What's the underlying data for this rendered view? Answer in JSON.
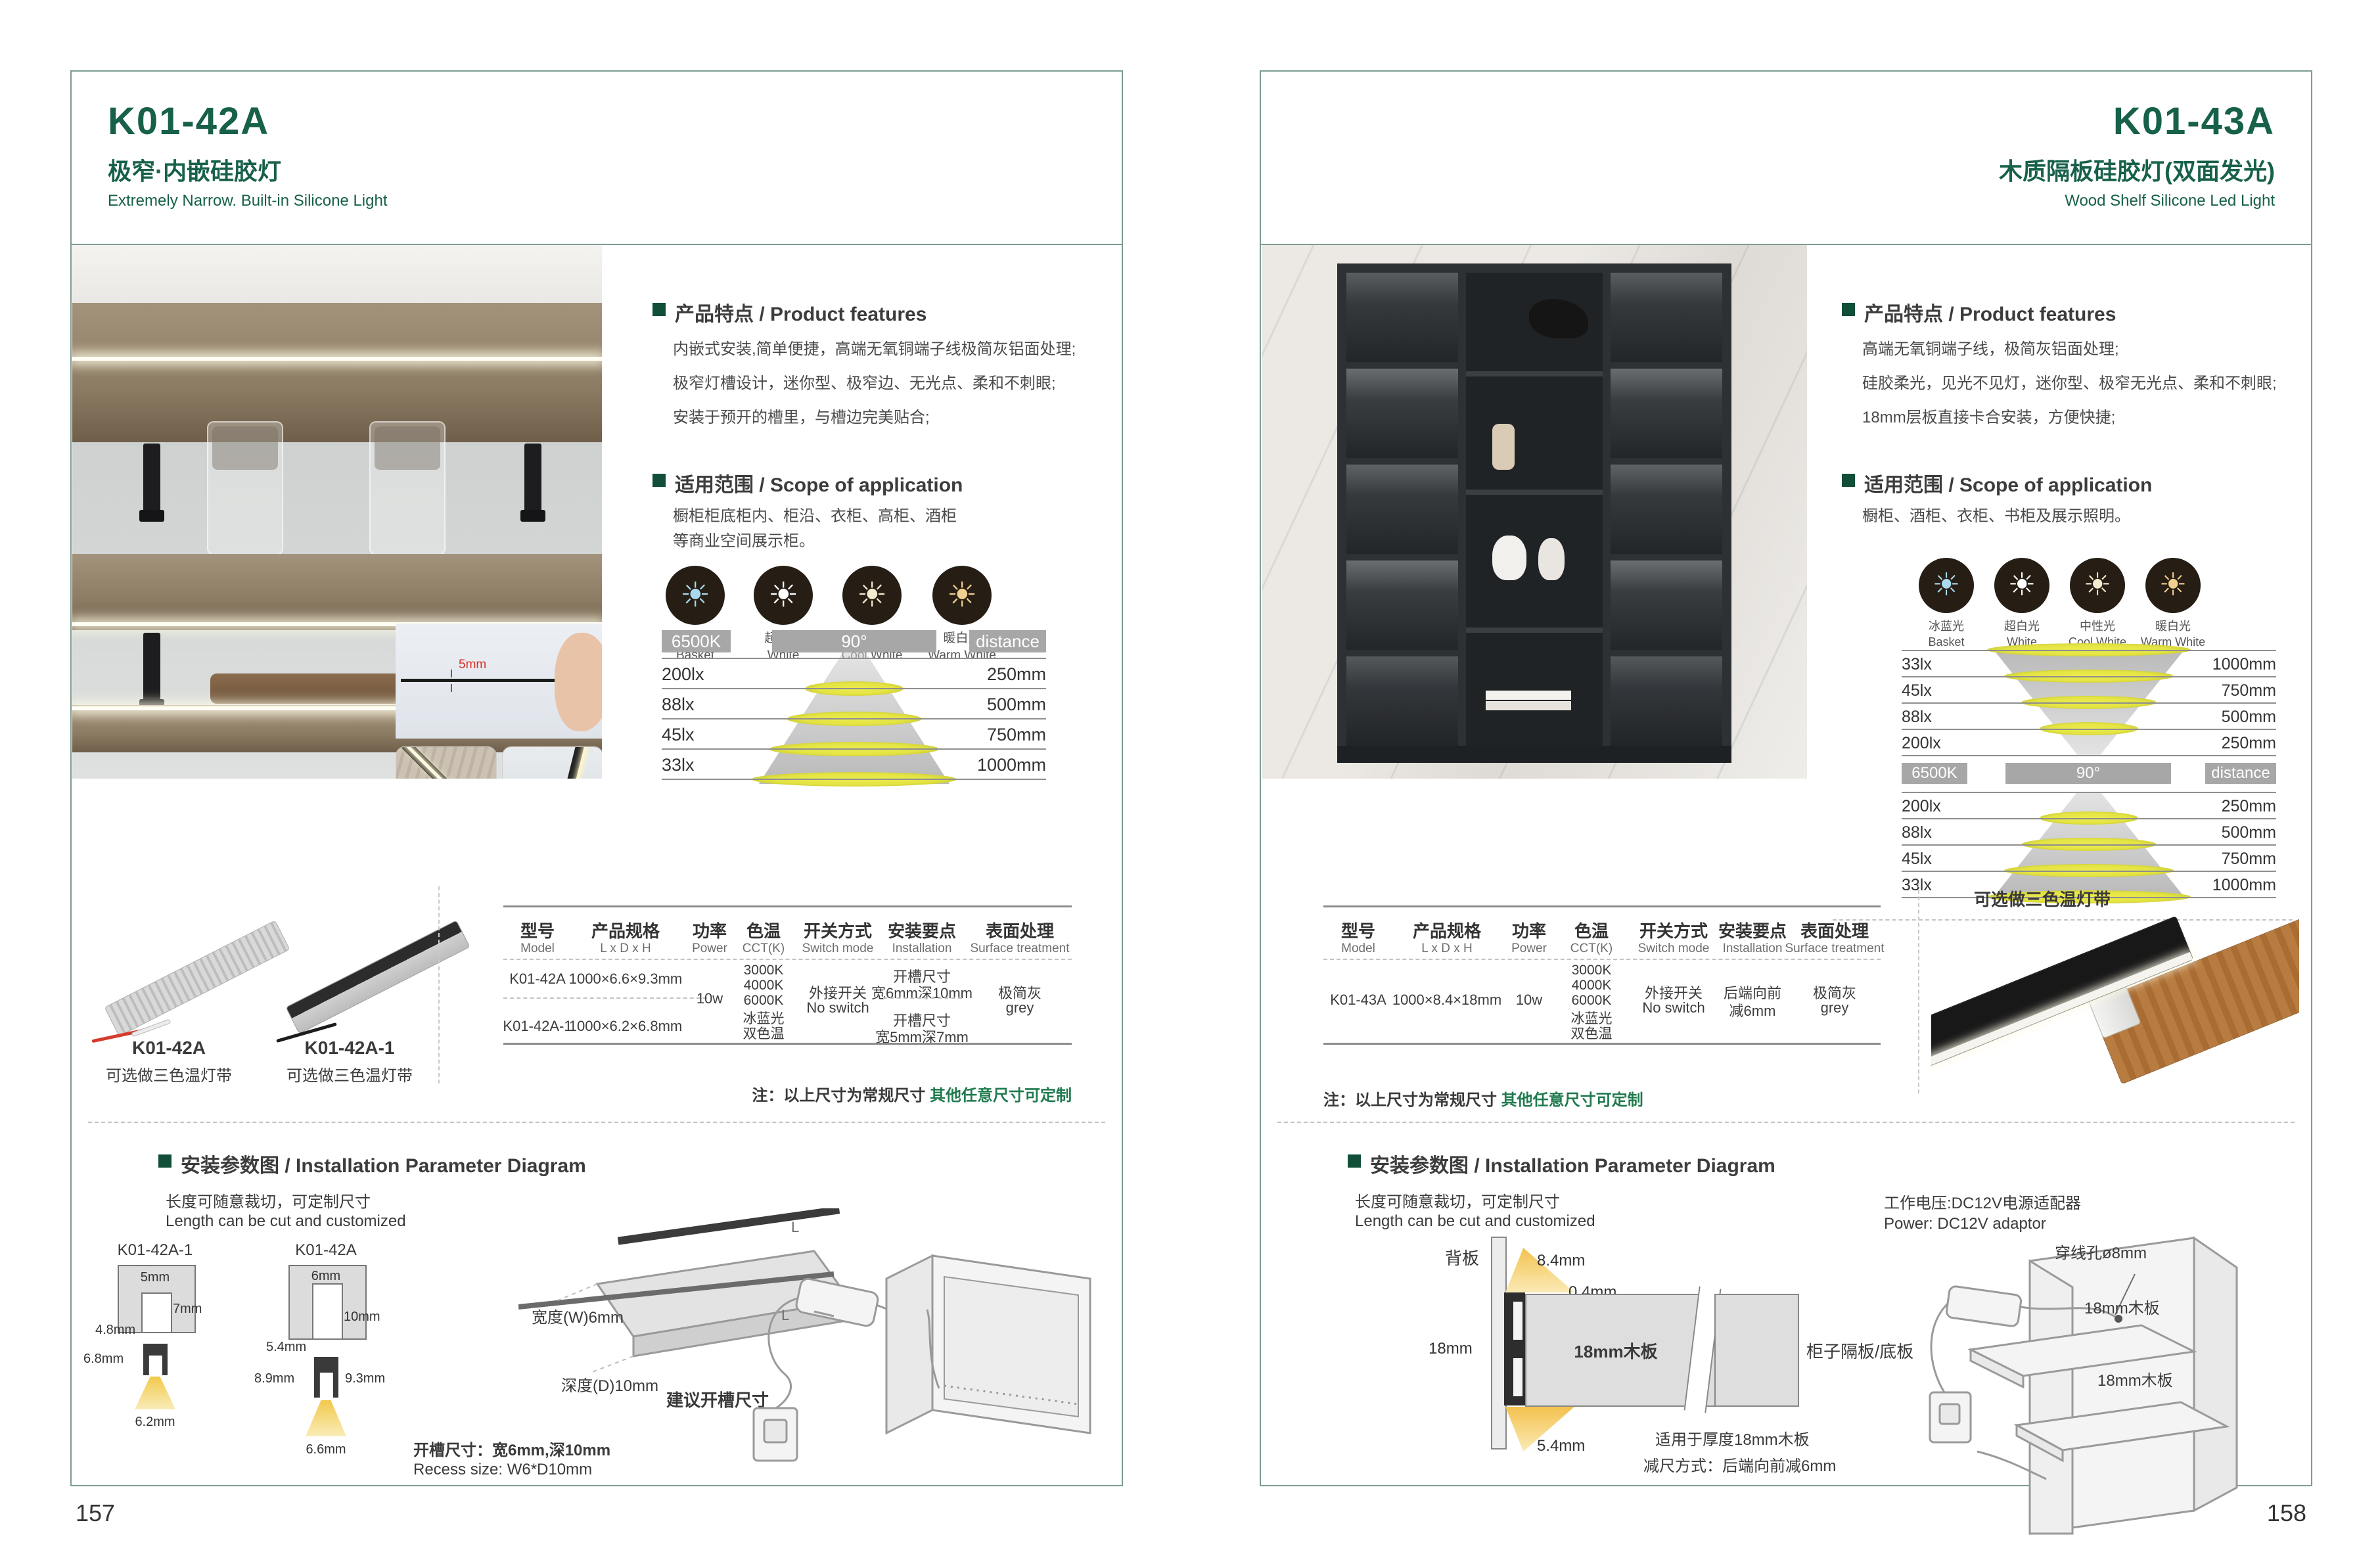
{
  "icons": {
    "cct": [
      {
        "cn": "冰蓝光",
        "en": "Basket",
        "color": "#a9d9ee"
      },
      {
        "cn": "超白光",
        "en": "White",
        "color": "#ffffff"
      },
      {
        "cn": "中性光",
        "en": "Cool White",
        "color": "#f5ebcf"
      },
      {
        "cn": "暖白光",
        "en": "Warm White",
        "color": "#f1cf8e"
      }
    ]
  },
  "colors": {
    "brand_green": "#17604a",
    "note_green": "#1f7a4d",
    "border_teal": "#7d9c93",
    "band_grey": "#a7a7a7"
  },
  "pages": {
    "left": {
      "page_number": "157",
      "model": "K01-42A",
      "subtitle_cn": "极窄·内嵌硅胶灯",
      "subtitle_en": "Extremely Narrow. Built-in Silicone Light",
      "features_heading": "产品特点 / Product features",
      "features": [
        "内嵌式安装,简单便捷，高端无氧铜端子线极简灰铝面处理;",
        "极窄灯槽设计，迷你型、极窄边、无光点、柔和不刺眼;",
        "安装于预开的槽里，与槽边完美贴合;"
      ],
      "scope_heading": "适用范围 / Scope of application",
      "scope": [
        "橱柜柜底柜内、柜沿、衣柜、高柜、酒柜",
        "等商业空间展示柜。"
      ],
      "photo_dim": "5mm",
      "lux": {
        "kelvin": "6500K",
        "angle": "90°",
        "distance": "distance",
        "rows": [
          {
            "lx": "200lx",
            "mm": "250mm"
          },
          {
            "lx": "88lx",
            "mm": "500mm"
          },
          {
            "lx": "45lx",
            "mm": "750mm"
          },
          {
            "lx": "33lx",
            "mm": "1000mm"
          }
        ]
      },
      "products": [
        {
          "name": "K01-42A",
          "desc": "可选做三色温灯带"
        },
        {
          "name": "K01-42A-1",
          "desc": "可选做三色温灯带"
        }
      ],
      "table": {
        "h": [
          {
            "cn": "型号",
            "en": "Model"
          },
          {
            "cn": "产品规格",
            "en": "L x D x H"
          },
          {
            "cn": "功率",
            "en": "Power"
          },
          {
            "cn": "色温",
            "en": "CCT(K)"
          },
          {
            "cn": "开关方式",
            "en": "Switch mode"
          },
          {
            "cn": "安装要点",
            "en": "Installation"
          },
          {
            "cn": "表面处理",
            "en": "Surface treatment"
          }
        ],
        "rows": [
          {
            "model": "K01-42A",
            "size": "1000×6.6×9.3mm",
            "inst1": "开槽尺寸",
            "inst2": "宽6mm深10mm"
          },
          {
            "model": "K01-42A-1",
            "size": "1000×6.2×6.8mm",
            "inst1": "开槽尺寸",
            "inst2": "宽5mm深7mm"
          }
        ],
        "power": "10w",
        "cct": [
          "3000K",
          "4000K",
          "6000K",
          "冰蓝光",
          "双色温"
        ],
        "switch1": "外接开关",
        "switch2": "No switch",
        "surface1": "极简灰",
        "surface2": "grey"
      },
      "note_prefix": "注：以上尺寸为常规尺寸 ",
      "note_highlight": "其他任意尺寸可定制",
      "install": {
        "heading": "安装参数图 / Installation Parameter Diagram",
        "len_cn": "长度可随意裁切，可定制尺寸",
        "len_en": "Length can be cut and customized",
        "d1": {
          "label": "K01-42A-1",
          "top": "5mm",
          "depth": "7mm",
          "inner": "4.8mm",
          "height": "6.8mm",
          "bottom": "6.2mm"
        },
        "d2": {
          "label": "K01-42A",
          "top": "6mm",
          "depth": "10mm",
          "inner": "5.4mm",
          "height_l": "8.9mm",
          "height_r": "9.3mm",
          "bottom": "6.6mm"
        },
        "slab": {
          "w": "宽度(W)6mm",
          "d": "深度(D)10mm",
          "cap": "建议开槽尺寸",
          "L": "L"
        },
        "recess_cn": "开槽尺寸：宽6mm,深10mm",
        "recess_en": "Recess size: W6*D10mm"
      }
    },
    "right": {
      "page_number": "158",
      "model": "K01-43A",
      "subtitle_cn": "木质隔板硅胶灯(双面发光)",
      "subtitle_en": "Wood Shelf Silicone Led Light",
      "features_heading": "产品特点 / Product features",
      "features": [
        "高端无氧铜端子线，极简灰铝面处理;",
        "硅胶柔光，见光不见灯，迷你型、极窄无光点、柔和不刺眼;",
        "18mm层板直接卡合安装，方便快捷;"
      ],
      "scope_heading": "适用范围 / Scope of application",
      "scope": [
        "橱柜、酒柜、衣柜、书柜及展示照明。"
      ],
      "product_note": "可选做三色温灯带",
      "lux": {
        "kelvin": "6500K",
        "angle": "90°",
        "distance": "distance",
        "rows_top": [
          {
            "lx": "33lx",
            "mm": "1000mm"
          },
          {
            "lx": "45lx",
            "mm": "750mm"
          },
          {
            "lx": "88lx",
            "mm": "500mm"
          },
          {
            "lx": "200lx",
            "mm": "250mm"
          }
        ],
        "rows_bottom": [
          {
            "lx": "200lx",
            "mm": "250mm"
          },
          {
            "lx": "88lx",
            "mm": "500mm"
          },
          {
            "lx": "45lx",
            "mm": "750mm"
          },
          {
            "lx": "33lx",
            "mm": "1000mm"
          }
        ]
      },
      "table": {
        "h": [
          {
            "cn": "型号",
            "en": "Model"
          },
          {
            "cn": "产品规格",
            "en": "L x D x H"
          },
          {
            "cn": "功率",
            "en": "Power"
          },
          {
            "cn": "色温",
            "en": "CCT(K)"
          },
          {
            "cn": "开关方式",
            "en": "Switch mode"
          },
          {
            "cn": "安装要点",
            "en": "Installation"
          },
          {
            "cn": "表面处理",
            "en": "Surface treatment"
          }
        ],
        "row": {
          "model": "K01-43A",
          "size": "1000×8.4×18mm",
          "power": "10w"
        },
        "cct": [
          "3000K",
          "4000K",
          "6000K",
          "冰蓝光",
          "双色温"
        ],
        "switch1": "外接开关",
        "switch2": "No switch",
        "inst1": "后端向前",
        "inst2": "减6mm",
        "surface1": "极简灰",
        "surface2": "grey"
      },
      "note_prefix": "注：以上尺寸为常规尺寸 ",
      "note_highlight": "其他任意尺寸可定制",
      "install": {
        "heading": "安装参数图 / Installation Parameter Diagram",
        "len_cn": "长度可随意裁切，可定制尺寸",
        "len_en": "Length can be cut and customized",
        "back_label": "背板",
        "dim_a": "8.4mm",
        "dim_b": "0.4mm",
        "dim_c": "18mm",
        "dim_d": "5.4mm",
        "board_label": "18mm木板",
        "shelf_label": "柜子隔板/底板",
        "note1": "适用于厚度18mm木板",
        "note2": "减尺方式：后端向前减6mm",
        "power_cn": "工作电压:DC12V电源适配器",
        "power_en": "Power: DC12V adaptor",
        "hole_label": "穿线孔ø8mm",
        "board1": "18mm木板",
        "board2": "18mm木板"
      }
    }
  }
}
